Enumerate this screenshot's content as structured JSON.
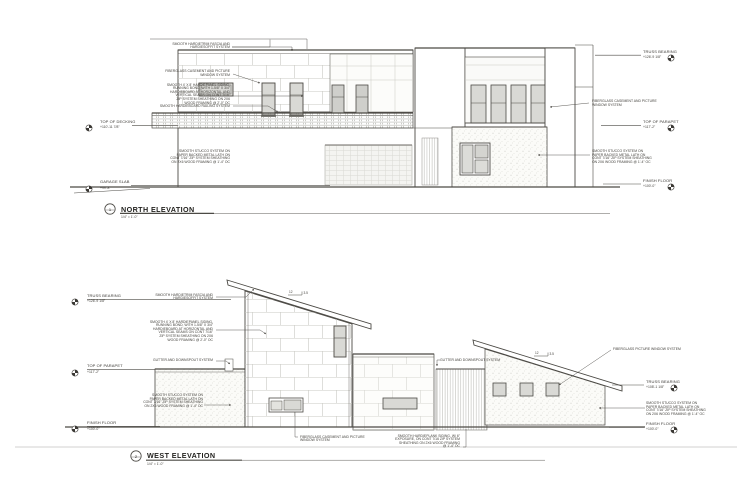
{
  "drawing": {
    "north": {
      "title": "NORTH ELEVATION",
      "scale": "1/4\" = 1'-0\"",
      "detail_number": "1",
      "annotations": {
        "fascia": "SMOOTH HARDIETRIM FASCIA AND\nHARDIESOFFIT SYSTEM",
        "window_upper": "FIBERGLASS CASEMENT AND PICTURE\nWINDOW SYSTEM",
        "panel_siding": "SMOOTH 4' X 8' HARDIEPANEL SIDING,\nRUNNING BOND, WITH 1-5/8\" X 3/4\"\nHARDIEBOARD AT HORIZONTAL AND\nVERTICAL SEAMS ON CONT 7/16\"\nZIP SYSTEM SHEATHING ON 2X6\nWOOD FRAMING @ 2'-0\" OC",
        "railing": "SMOOTH HARDIEBOARD RAILING SYSTEM",
        "stucco_left": "SMOOTH STUCCO SYSTEM ON\nPAPER BACKED METAL LATH ON\nCONT 7/16\" ZIP SYSTEM SHEATHING\nON 2X6 WOOD FRAMING @ 1'-4\" OC",
        "window_right": "FIBERGLASS CASEMENT AND PICTURE\nWINDOW SYSTEM",
        "stucco_right": "SMOOTH STUCCO SYSTEM ON\nPAPER BACKED METAL LATH ON\nCONT 7/16\" ZIP SYSTEM SHEATHING\nON 2X6 WOOD FRAMING @ 1'-4\" OC"
      },
      "levels": {
        "top_of_decking": {
          "name": "TOP OF DECKING",
          "elevation": "+110'-11 7/8\""
        },
        "garage_slab": {
          "name": "GARAGE SLAB",
          "elevation": "+99'-8\""
        },
        "truss_bearing": {
          "name": "TRUSS BEARING",
          "elevation": "+126'-9 1/8\""
        },
        "top_of_parapet": {
          "name": "TOP OF PARAPET",
          "elevation": "+117'-2\""
        },
        "finish_floor": {
          "name": "FINISH FLOOR",
          "elevation": "+100'-0\""
        }
      }
    },
    "west": {
      "title": "WEST ELEVATION",
      "scale": "1/4\" = 1'-0\"",
      "detail_number": "2",
      "annotations": {
        "fascia": "SMOOTH HARDIETRIM FASCIA AND\nHARDIESOFFIT SYSTEM",
        "panel_siding": "SMOOTH 4' X 8' HARDIEPANEL SIDING,\nRUNNING BOND, WITH 1-5/8\" X 3/4\"\nHARDIEBOARD AT HORIZONTAL AND\nVERTICAL SEAMS ON CONT 7/16\"\nZIP SYSTEM SHEATHING ON 2X6\nWOOD FRAMING @ 2'-0\" OC",
        "gutter_left": "GUTTER AND DOWNSPOUT SYSTEM",
        "gutter_right": "GUTTER AND DOWNSPOUT SYSTEM",
        "stucco_left": "SMOOTH STUCCO SYSTEM ON\nPAPER BACKED METAL LATH ON\nCONT 7/16\" ZIP SYSTEM SHEATHING\nON 2X6 WOOD FRAMING @ 1'-4\" OC",
        "window_lower": "FIBERGLASS CASEMENT AND PICTURE\nWINDOW SYSTEM",
        "plank_siding": "SMOOTH HARDIEPLANK SIDING, W/ 6\"\nEXPOSURE, ON CONT 7/16 ZIP SYSTEM\nSHEATHING ON 2X6 WOOD FRAMING\n@ 1'-4\" OC",
        "picture_window": "FIBERGLASS PICTURE WINDOW SYSTEM",
        "stucco_right": "SMOOTH STUCCO SYSTEM ON\nPAPER BACKED METAL LATH ON\nCONT 7/16\" ZIP SYSTEM SHEATHING\nON 2X6 WOOD FRAMING @ 1'-4\" OC"
      },
      "levels": {
        "truss_bearing_left": {
          "name": "TRUSS BEARING",
          "elevation": "+126'-9 1/8\""
        },
        "top_of_parapet": {
          "name": "TOP OF PARAPET",
          "elevation": "+117'-2\""
        },
        "finish_floor_left": {
          "name": "FINISH FLOOR",
          "elevation": "+100'-0\""
        },
        "truss_bearing_right": {
          "name": "TRUSS BEARING",
          "elevation": "+108'-1 1/8\""
        },
        "finish_floor_right": {
          "name": "FINISH FLOOR",
          "elevation": "+100'-0\""
        }
      },
      "slopes": [
        {
          "run": "12",
          "rise": "3.5"
        },
        {
          "run": "12",
          "rise": "3.5"
        }
      ]
    }
  }
}
